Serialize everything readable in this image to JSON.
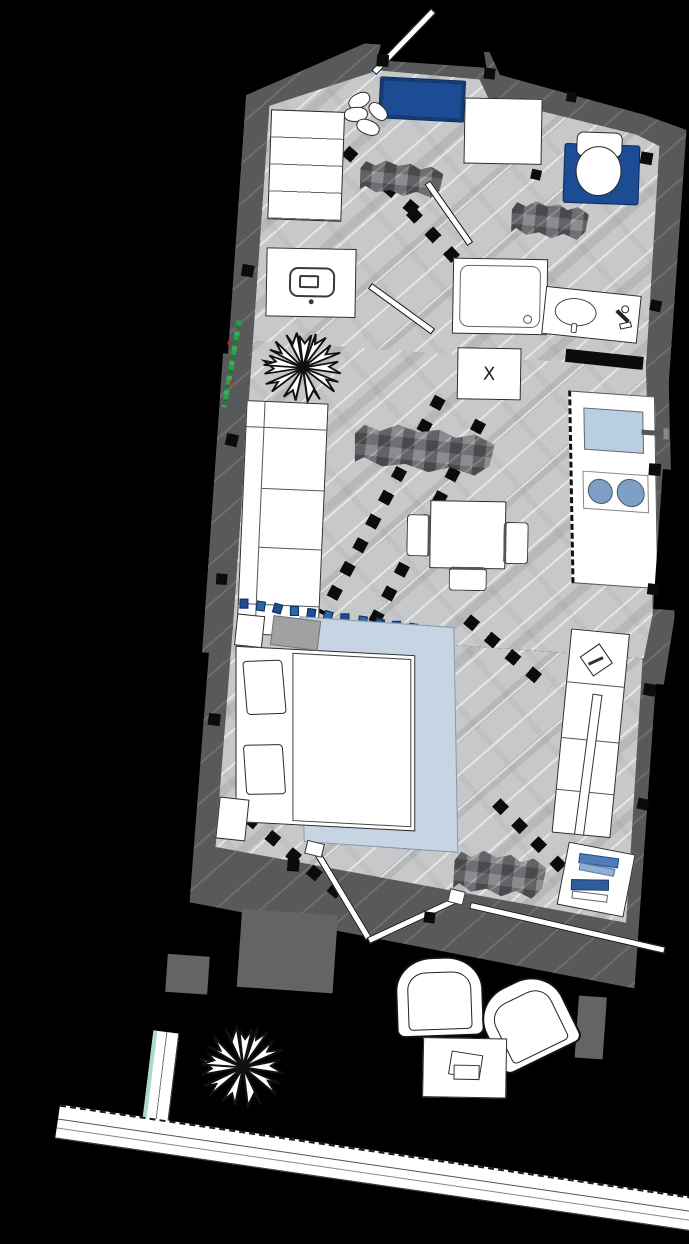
{
  "plan": {
    "type": "apartment floor plan, top-down architectural drawing, slightly rotated",
    "markers": {
      "shaft_label": "X"
    },
    "labels": [
      {
        "id": "label-hallway",
        "censored": true,
        "style": "pixelated gray mosaic",
        "text": ""
      },
      {
        "id": "label-bathroom",
        "censored": true,
        "style": "pixelated gray mosaic",
        "text": ""
      },
      {
        "id": "label-living",
        "censored": true,
        "style": "pixelated gray mosaic",
        "text": ""
      },
      {
        "id": "label-bedroom",
        "censored": true,
        "style": "pixelated gray mosaic",
        "text": ""
      }
    ]
  },
  "rooms": {
    "hallway": {
      "furniture": [
        "entry-door",
        "shoe-bench",
        "shoes",
        "shelf-wardrobe",
        "hall-cabinet"
      ],
      "label_censored": true
    },
    "bathroom": {
      "furniture": [
        "toilet",
        "toilet-mat",
        "shower",
        "vanity-sink",
        "washing-machine",
        "faucet"
      ],
      "label_censored": true
    },
    "living-kitchen": {
      "furniture": [
        "sofa",
        "plant",
        "dining-table",
        "dining-chairs",
        "kitchen-counter",
        "kitchen-sink",
        "cooktop",
        "shaft-x-marker"
      ],
      "label_censored": true
    },
    "sleeping-area": {
      "furniture": [
        "double-bed",
        "pillows",
        "rug",
        "nightstands",
        "wardrobe",
        "bookshelf",
        "curtain-divider"
      ],
      "label_censored": true
    },
    "terrace": {
      "furniture": [
        "armchairs",
        "coffee-table",
        "plant",
        "railing",
        "terrace-doors",
        "sliding-door"
      ]
    }
  },
  "counts": {
    "curtain_segments": 13,
    "wardrobe_shelves": 4,
    "sofa_seats": 3,
    "dining_chairs": 3,
    "cooktop_burners": 2,
    "armchairs": 2,
    "plants": 3,
    "book_stacks": 4,
    "interior_doors": 2
  },
  "colors": {
    "background": "#000000",
    "wall_gray": "#58595b",
    "floor_gray": "#c7c8c9",
    "accent_navy": "#1b4c94",
    "rug_light_blue": "#c6d4e4",
    "sink_blue": "#b9cfe0",
    "burner_blue": "#7da0c4",
    "plant_green": "#2ba04a",
    "railing_teal": "#a8dcc6",
    "book_blue_dark": "#2e5f9b",
    "book_blue_mid": "#4d7db8",
    "book_blue_light": "#8fb0d4"
  }
}
